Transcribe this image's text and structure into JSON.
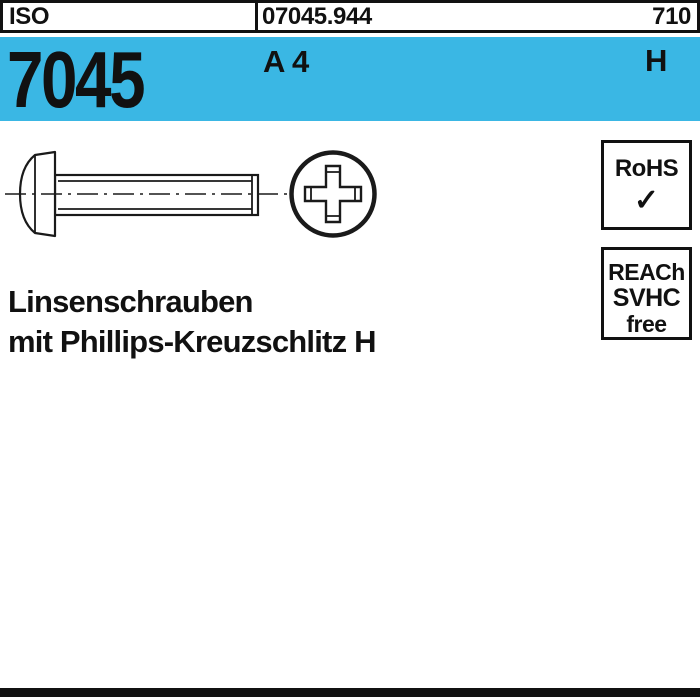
{
  "colors": {
    "band_bg": "#3ab7e4",
    "ink": "#111111",
    "page_bg": "#ffffff"
  },
  "header": {
    "standard_label": "ISO",
    "article_number": "07045.944",
    "catalog_page": "710"
  },
  "band": {
    "standard_number": "7045",
    "material": "A 4",
    "drive": "H"
  },
  "title": {
    "line1": "Linsenschrauben",
    "line2": "mit Phillips-Kreuzschlitz H"
  },
  "badges": {
    "rohs": {
      "label": "RoHS",
      "check": "✓"
    },
    "reach": {
      "lines": [
        "REACh",
        "SVHC",
        "free"
      ]
    }
  }
}
